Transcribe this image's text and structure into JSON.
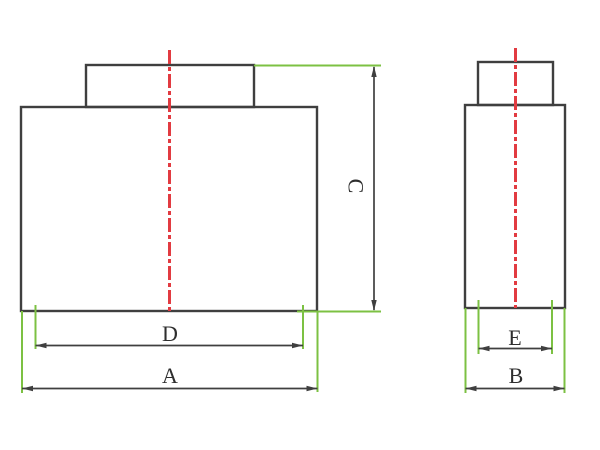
{
  "drawing": {
    "dimensions": {
      "a_label": "A",
      "b_label": "B",
      "c_label": "C",
      "d_label": "D",
      "e_label": "E"
    },
    "colors": {
      "outline": "#3f3f3f",
      "centerline": "#e23b41",
      "extension": "#7cc143",
      "dimension": "#3f3f3f",
      "text": "#2e2e2e",
      "background": "#ffffff"
    }
  }
}
